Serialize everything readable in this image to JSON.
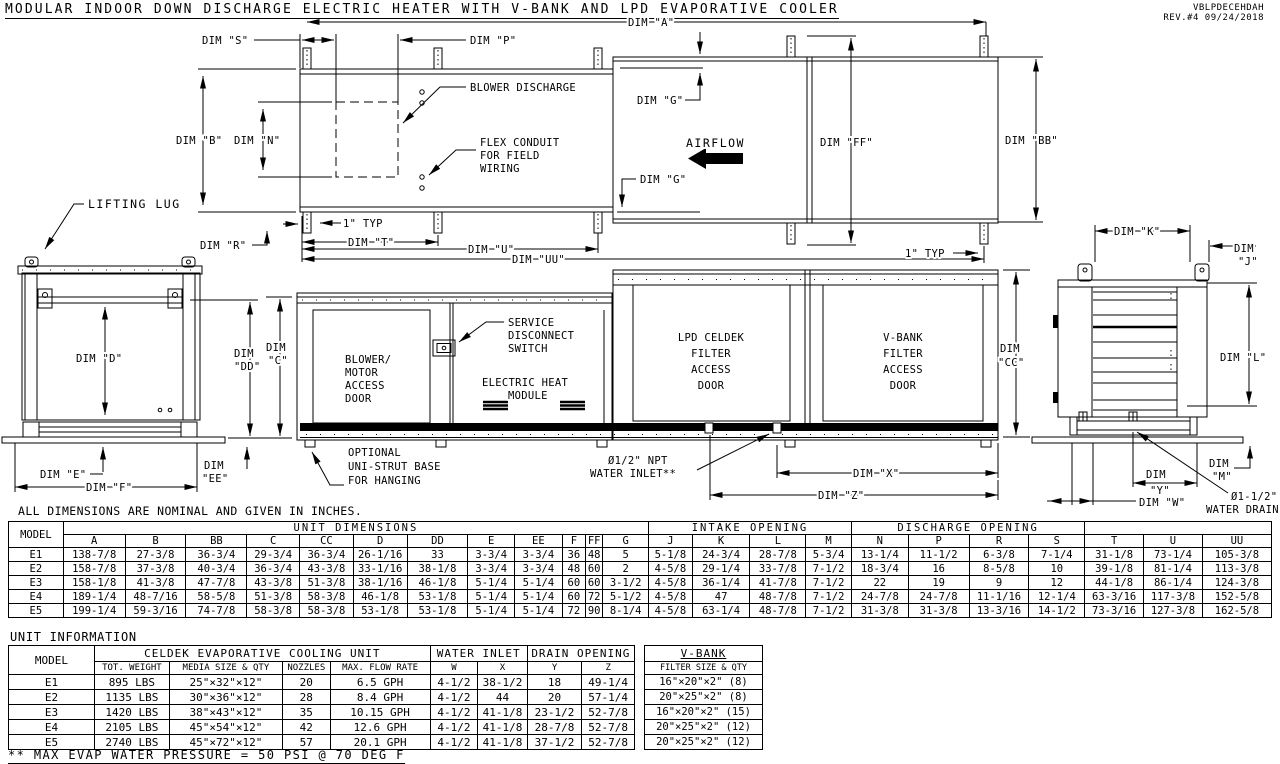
{
  "header": {
    "title": "MODULAR INDOOR DOWN DISCHARGE ELECTRIC HEATER WITH V-BANK AND LPD EVAPORATIVE COOLER",
    "doc_code": "VBLPDECEHDAH",
    "revision": "REV.#4   09/24/2018"
  },
  "drawing": {
    "dim_a": "DIM \"A\"",
    "dim_s": "DIM \"S\"",
    "dim_p": "DIM \"P\"",
    "dim_b": "DIM \"B\"",
    "dim_n": "DIM \"N\"",
    "dim_g": "DIM \"G\"",
    "dim_r": "DIM \"R\"",
    "dim_t": "DIM \"T\"",
    "dim_u": "DIM \"U\"",
    "dim_uu": "DIM \"UU\"",
    "dim_ff": "DIM \"FF\"",
    "dim_bb": "DIM \"BB\"",
    "typ_1in": "1\" TYP",
    "airflow": "AIRFLOW",
    "blower_discharge": "BLOWER DISCHARGE",
    "flex_conduit": [
      "FLEX CONDUIT",
      "FOR FIELD",
      "WIRING"
    ],
    "lifting_lug": "LIFTING LUG",
    "dim_d": "DIM \"D\"",
    "dim_dd": [
      "DIM",
      "\"DD\""
    ],
    "dim_c": [
      "DIM",
      "\"C\""
    ],
    "dim_e": "DIM \"E\"",
    "dim_f": "DIM \"F\"",
    "dim_ee": [
      "DIM",
      "\"EE\""
    ],
    "blower_door": [
      "BLOWER/",
      "MOTOR",
      "ACCESS",
      "DOOR"
    ],
    "service_switch": [
      "SERVICE",
      "DISCONNECT",
      "SWITCH"
    ],
    "electric_heat": [
      "ELECTRIC HEAT",
      "MODULE"
    ],
    "unistrut": [
      "OPTIONAL",
      "UNI-STRUT BASE",
      "FOR HANGING"
    ],
    "water_inlet": [
      "Ø1/2\" NPT",
      "WATER INLET**"
    ],
    "lpd_door": [
      "LPD CELDEK",
      "FILTER",
      "ACCESS",
      "DOOR"
    ],
    "vbank_door": [
      "V-BANK",
      "FILTER",
      "ACCESS",
      "DOOR"
    ],
    "dim_cc": [
      "DIM",
      "\"CC\""
    ],
    "dim_x": "DIM \"X\"",
    "dim_z": "DIM \"Z\"",
    "dim_k": "DIM \"K\"",
    "dim_j": [
      "DIM",
      "\"J\""
    ],
    "dim_l": "DIM \"L\"",
    "dim_m": [
      "DIM",
      "\"M\""
    ],
    "dim_y": [
      "DIM",
      "\"Y\""
    ],
    "dim_w": "DIM \"W\"",
    "water_drain": [
      "Ø1-1/2\"",
      "WATER DRAIN"
    ]
  },
  "notes": {
    "dimensions_note": "ALL DIMENSIONS ARE NOMINAL AND GIVEN IN INCHES.",
    "unit_information_title": "UNIT INFORMATION",
    "footnote": "** MAX EVAP WATER PRESSURE = 50 PSI @ 70 DEG F"
  },
  "tables": {
    "unit_dimensions": {
      "model_header": "MODEL",
      "group_headers": [
        "UNIT DIMENSIONS",
        "INTAKE OPENING",
        "DISCHARGE OPENING",
        ""
      ],
      "columns": [
        "A",
        "B",
        "BB",
        "C",
        "CC",
        "D",
        "DD",
        "E",
        "EE",
        "F",
        "FF",
        "G",
        "J",
        "K",
        "L",
        "M",
        "N",
        "P",
        "R",
        "S",
        "T",
        "U",
        "UU"
      ],
      "rows": [
        [
          "E1",
          "138-7/8",
          "27-3/8",
          "36-3/4",
          "29-3/4",
          "36-3/4",
          "26-1/16",
          "33",
          "3-3/4",
          "3-3/4",
          "36",
          "48",
          "5",
          "5-1/8",
          "24-3/4",
          "28-7/8",
          "5-3/4",
          "13-1/4",
          "11-1/2",
          "6-3/8",
          "7-1/4",
          "31-1/8",
          "73-1/4",
          "105-3/8"
        ],
        [
          "E2",
          "158-7/8",
          "37-3/8",
          "40-3/4",
          "36-3/4",
          "43-3/8",
          "33-1/16",
          "38-1/8",
          "3-3/4",
          "3-3/4",
          "48",
          "60",
          "2",
          "4-5/8",
          "29-1/4",
          "33-7/8",
          "7-1/2",
          "18-3/4",
          "16",
          "8-5/8",
          "10",
          "39-1/8",
          "81-1/4",
          "113-3/8"
        ],
        [
          "E3",
          "158-1/8",
          "41-3/8",
          "47-7/8",
          "43-3/8",
          "51-3/8",
          "38-1/16",
          "46-1/8",
          "5-1/4",
          "5-1/4",
          "60",
          "60",
          "3-1/2",
          "4-5/8",
          "36-1/4",
          "41-7/8",
          "7-1/2",
          "22",
          "19",
          "9",
          "12",
          "44-1/8",
          "86-1/4",
          "124-3/8"
        ],
        [
          "E4",
          "189-1/4",
          "48-7/16",
          "58-5/8",
          "51-3/8",
          "58-3/8",
          "46-1/8",
          "53-1/8",
          "5-1/4",
          "5-1/4",
          "60",
          "72",
          "5-1/2",
          "4-5/8",
          "47",
          "48-7/8",
          "7-1/2",
          "24-7/8",
          "24-7/8",
          "11-1/16",
          "12-1/4",
          "63-3/16",
          "117-3/8",
          "152-5/8"
        ],
        [
          "E5",
          "199-1/4",
          "59-3/16",
          "74-7/8",
          "58-3/8",
          "58-3/8",
          "53-1/8",
          "53-1/8",
          "5-1/4",
          "5-1/4",
          "72",
          "90",
          "8-1/4",
          "4-5/8",
          "63-1/4",
          "48-7/8",
          "7-1/2",
          "31-3/8",
          "31-3/8",
          "13-3/16",
          "14-1/2",
          "73-3/16",
          "127-3/8",
          "162-5/8"
        ]
      ]
    },
    "unit_information": {
      "model_header": "MODEL",
      "group_headers": [
        "CELDEK EVAPORATIVE COOLING UNIT",
        "WATER INLET",
        "DRAIN OPENING"
      ],
      "columns": [
        "TOT. WEIGHT",
        "MEDIA SIZE & QTY",
        "NOZZLES",
        "MAX. FLOW RATE",
        "W",
        "X",
        "Y",
        "Z"
      ],
      "rows": [
        [
          "E1",
          "895 LBS",
          "25\"×32\"×12\"",
          "20",
          "6.5 GPH",
          "4-1/2",
          "38-1/2",
          "18",
          "49-1/4"
        ],
        [
          "E2",
          "1135 LBS",
          "30\"×36\"×12\"",
          "28",
          "8.4 GPH",
          "4-1/2",
          "44",
          "20",
          "57-1/4"
        ],
        [
          "E3",
          "1420 LBS",
          "38\"×43\"×12\"",
          "35",
          "10.15 GPH",
          "4-1/2",
          "41-1/8",
          "23-1/2",
          "52-7/8"
        ],
        [
          "E4",
          "2105 LBS",
          "45\"×54\"×12\"",
          "42",
          "12.6 GPH",
          "4-1/2",
          "41-1/8",
          "28-7/8",
          "52-7/8"
        ],
        [
          "E5",
          "2740 LBS",
          "45\"×72\"×12\"",
          "57",
          "20.1 GPH",
          "4-1/2",
          "41-1/8",
          "37-1/2",
          "52-7/8"
        ]
      ]
    },
    "vbank": {
      "title": "V-BANK",
      "column": "FILTER SIZE & QTY",
      "rows": [
        "16\"×20\"×2\" (8)",
        "20\"×25\"×2\" (8)",
        "16\"×20\"×2\" (15)",
        "20\"×25\"×2\" (12)",
        "20\"×25\"×2\" (12)"
      ]
    }
  }
}
